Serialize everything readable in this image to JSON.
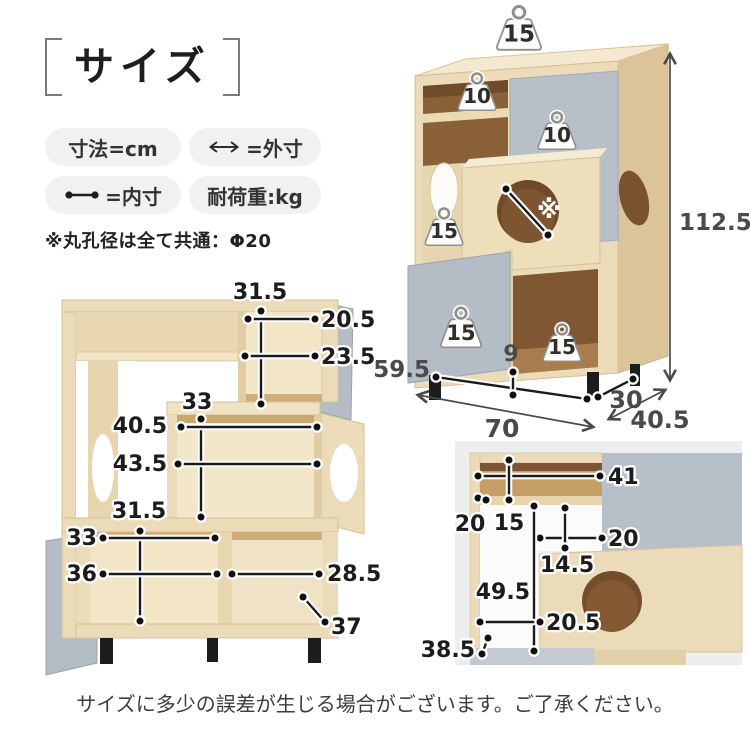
{
  "header": {
    "title": "サイズ",
    "legend": [
      {
        "label": "寸法=cm"
      },
      {
        "label": "=外寸",
        "icon": "double-arrow-icon"
      },
      {
        "label": "=内寸",
        "icon": "dot-line-icon"
      },
      {
        "label": "耐荷重:kg"
      }
    ],
    "note": "※丸孔径は全て共通：Φ20"
  },
  "iso_view": {
    "weights": {
      "top": "15",
      "shelf": "10",
      "door": "10",
      "left": "15",
      "bottom_door": "15",
      "cube": "15"
    },
    "hole_mark": "※",
    "dims": {
      "height": "112.5",
      "leg_span": "59.5",
      "leg_height": "9",
      "width": "70",
      "inner_depth": "30",
      "depth": "40.5"
    }
  },
  "front_view": {
    "dims": {
      "upper_h": "31.5",
      "upper_w1": "20.5",
      "upper_w2": "23.5",
      "mid_h": "33",
      "mid_w1": "40.5",
      "mid_w2": "43.5",
      "lower_h": "31.5",
      "lower_w1": "33",
      "lower_w2": "36",
      "lower_w3": "28.5",
      "lower_d": "37"
    }
  },
  "detail_view": {
    "dims": {
      "top_w": "41",
      "side_d": "20",
      "shelf_h": "15",
      "step_w": "20",
      "step_h": "14.5",
      "total_h": "49.5",
      "bottom_w": "20.5",
      "bottom_d": "38.5"
    }
  },
  "footer": {
    "note": "サイズに多少の誤差が生じる場合がございます。ご了承ください。"
  },
  "colors": {
    "wood": "#ecdbb8",
    "wood_side": "#dcc49a",
    "wood_top": "#f4e8d0",
    "interior_dark": "#7f5630",
    "grey_panel": "#b7bfc9",
    "leg": "#1c1c1c",
    "dim_text": "#1c1c1c",
    "plain_dim_text": "#4a4a4a",
    "badge_bg": "#f1f1f1",
    "detail_bg": "#eceef0",
    "background": "#ffffff"
  }
}
